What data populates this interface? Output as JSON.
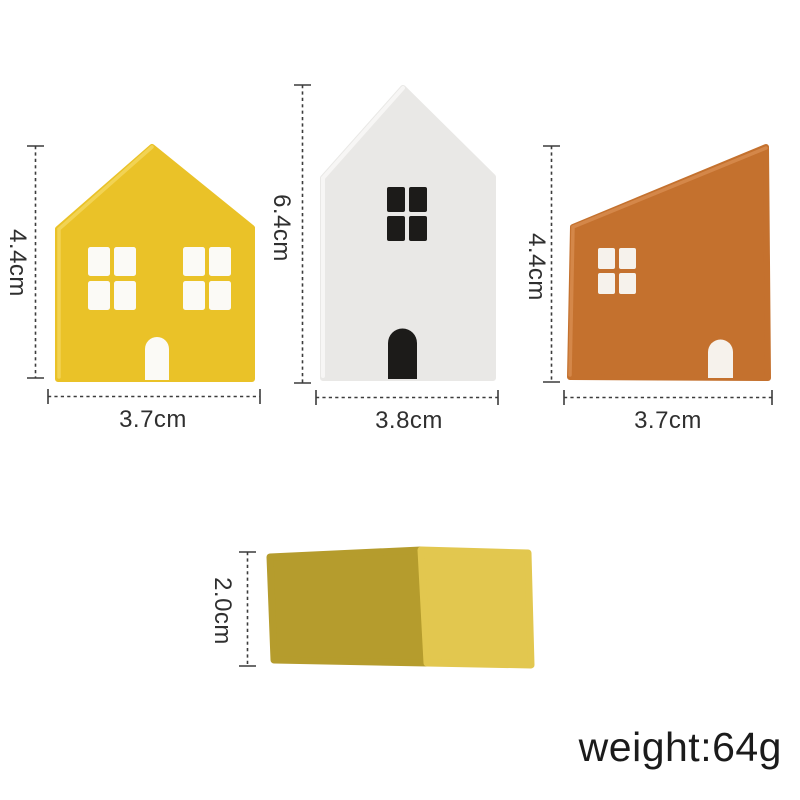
{
  "houses": [
    {
      "id": "yellow-house",
      "height_label": "4.4cm",
      "width_label": "3.7cm",
      "body_color": "#EAC228",
      "edge_color": "#F3D558",
      "detail_color": "#FBFAF6"
    },
    {
      "id": "white-house",
      "height_label": "6.4cm",
      "width_label": "3.8cm",
      "body_color": "#E9E8E6",
      "edge_color": "#F8F7F6",
      "detail_color": "#1C1B19"
    },
    {
      "id": "orange-house",
      "height_label": "4.4cm",
      "width_label": "3.7cm",
      "body_color": "#C4712E",
      "edge_color": "#D68A4D",
      "detail_color": "#F6F2EC"
    }
  ],
  "block": {
    "id": "yellow-block",
    "height_label": "2.0cm",
    "side_color": "#B59C2D",
    "front_color": "#E2C74F"
  },
  "weight": {
    "label": "weight:64g"
  },
  "style": {
    "dimension_line_color": "#3C3C3C",
    "dimension_text_color": "#2F2F2F",
    "weight_text_color": "#1B1B1B",
    "background_color": "#FFFFFF"
  }
}
